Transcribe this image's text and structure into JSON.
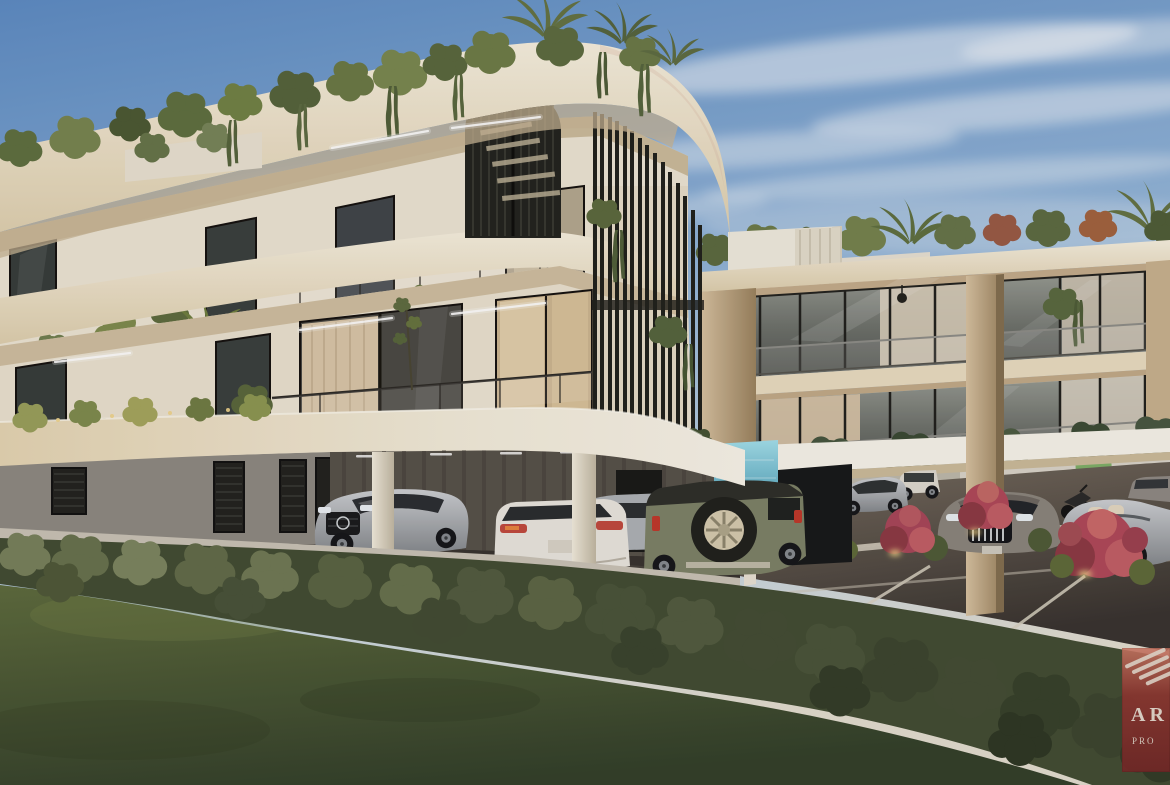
{
  "meta": {
    "scene": "3D architectural rendering (real-estate visualization)",
    "subject": "Modern three-storey apartment complex with curved cream fascias, rooftop and balcony greenery, vertical louver screen, spiral staircase, covered parking with cars, outdoor parking lot, lawn and trimmed hedge in foreground",
    "time_of_day": "dusk",
    "sky": "blue with wispy cirrus clouds"
  },
  "watermark": {
    "name": "developer-logo",
    "line1": "AR",
    "line2": "PRO",
    "note": "maroon logo square partially cropped at right edge",
    "emblem": "wing-stripes",
    "bg_color": "#8a3430",
    "text_color": "#d6cbc0"
  },
  "palette": {
    "sky_top": "#5d8cc4",
    "sky_horizon": "#d6dfe2",
    "cloud": "#f2f5f7",
    "facade_light": "#f3ecdb",
    "facade_cream": "#e4d5b6",
    "facade_tan": "#c9b293",
    "louver_dark": "#20211c",
    "glass_dark": "#3a403e",
    "curtain_warm": "#d9c6a8",
    "lawn_green": "#4d5c33",
    "hedge_green": "#3d4830",
    "asphalt": "#4b443c",
    "pool_teal": "#5fb6cc",
    "bush_red": "#b0495a",
    "car_silver": "#b9bdc1",
    "car_white": "#e9e6df",
    "car_olive": "#7d8268"
  },
  "scene": {
    "buildings": [
      {
        "name": "main-building",
        "floors": 3,
        "features": [
          "curved-corner-fascias",
          "spiral-staircase",
          "vertical-louver-screen",
          "balcony-planting",
          "ground-floor-garage"
        ]
      },
      {
        "name": "right-wing",
        "floors": 2,
        "features": [
          "glass-balconies",
          "beige-piers",
          "rooftop-garden",
          "carport-canopy",
          "pendant-lamp"
        ]
      }
    ],
    "features": [
      "pool-glimpse",
      "white-boundary-wall",
      "green-sign",
      "linear-soffit-lights",
      "planter-uplights"
    ],
    "vehicles": [
      {
        "name": "silver-mercedes-sedan",
        "location": "garage-left"
      },
      {
        "name": "white-sedan-rear",
        "location": "garage-center"
      },
      {
        "name": "silver-sedan-side",
        "location": "garage-center"
      },
      {
        "name": "olive-suv-spare-wheel",
        "location": "garage-right"
      },
      {
        "name": "silver-fastback",
        "location": "parking-lot"
      },
      {
        "name": "white-suv",
        "location": "parking-lot"
      },
      {
        "name": "chrome-grille-sedan",
        "location": "parking-lot"
      },
      {
        "name": "silver-convertible",
        "location": "parking-lot-right"
      },
      {
        "name": "dark-car-far-right",
        "location": "parking-lot-right"
      },
      {
        "name": "motorcycle",
        "location": "parking-lot"
      }
    ],
    "landscape": [
      "front-lawn",
      "trimmed-hedge",
      "red-flowering-bushes",
      "rooftop-plants",
      "hanging-vines"
    ]
  }
}
